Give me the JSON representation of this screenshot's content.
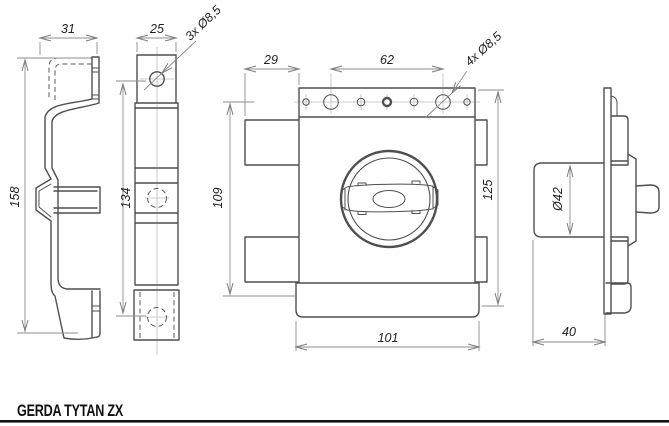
{
  "title": "GERDA TYTAN ZX",
  "views": {
    "bracket_side": {
      "width_top": "31",
      "height_left": "158"
    },
    "bracket_front": {
      "width_top": "25",
      "height_left": "134",
      "hole_callout": "3x Ø8,5"
    },
    "lock_front": {
      "tab_offset": "29",
      "hole_spacing": "62",
      "hole_callout": "4x Ø8,5",
      "height_left": "109",
      "height_right": "125",
      "base_width": "101"
    },
    "lock_side": {
      "knob_diameter": "Ø42",
      "depth_bottom": "40"
    }
  },
  "colors": {
    "outline": "#4f4f4f",
    "dimension_line": "#8d8d8d",
    "dimension_text": "#1f1f1f",
    "footer_rule": "#111111"
  }
}
